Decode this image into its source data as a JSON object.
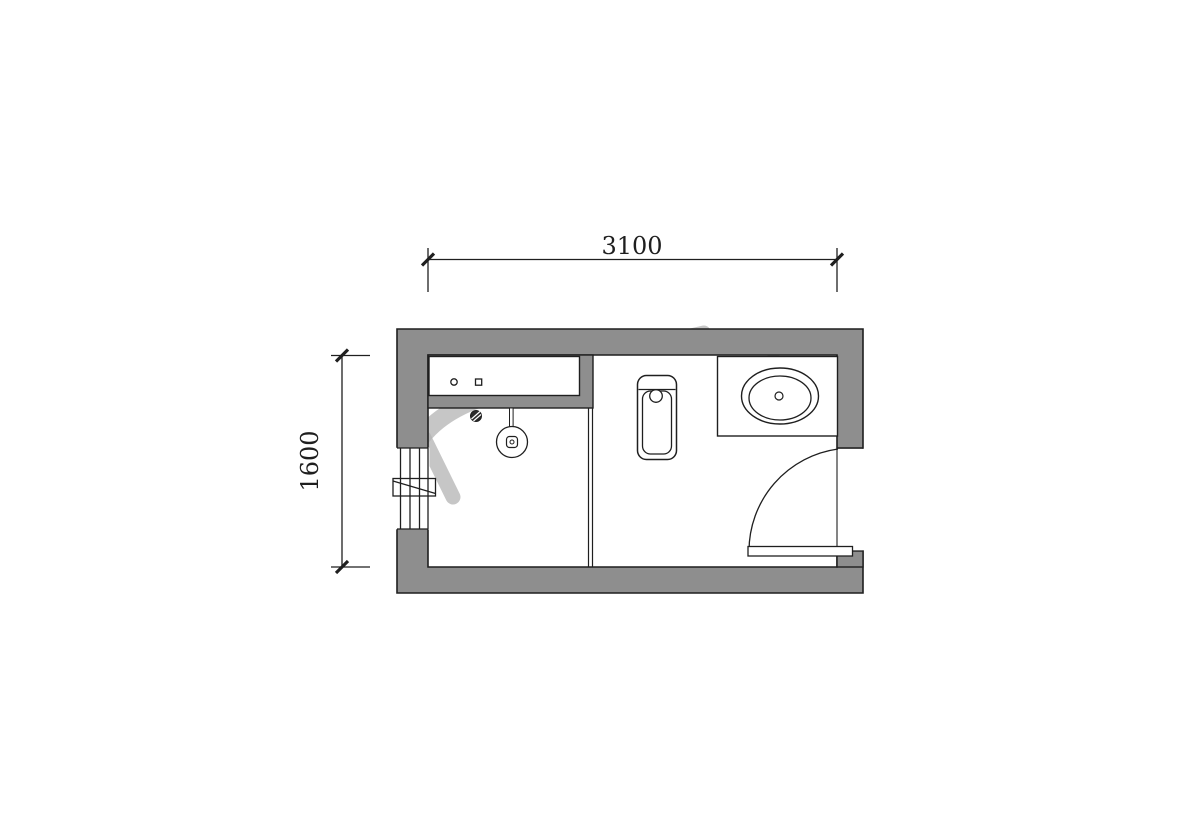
{
  "document": {
    "type": "bathroom-floor-plan",
    "background_color": "#ffffff"
  },
  "dimensions": {
    "width": {
      "label": "3100"
    },
    "height": {
      "label": "1600"
    }
  },
  "room": {
    "fixtures": [
      {
        "name": "counter-shelf",
        "details": "wall niche shelf with supply point circle and square symbols"
      },
      {
        "name": "floor-drain"
      },
      {
        "name": "shower-head"
      },
      {
        "name": "window",
        "details": "window with sill marker crossed by diagonal"
      },
      {
        "name": "glass-partition"
      },
      {
        "name": "squat-toilet"
      },
      {
        "name": "washbasin-counter",
        "details": "counter with oval basin and drain"
      },
      {
        "name": "door",
        "details": "inward swing door with quarter-circle arc"
      }
    ]
  },
  "colors": {
    "wall_fill": "#8e8e8e",
    "line": "#1f1f1f",
    "watermark": "#b2b2b2",
    "background": "#ffffff"
  }
}
